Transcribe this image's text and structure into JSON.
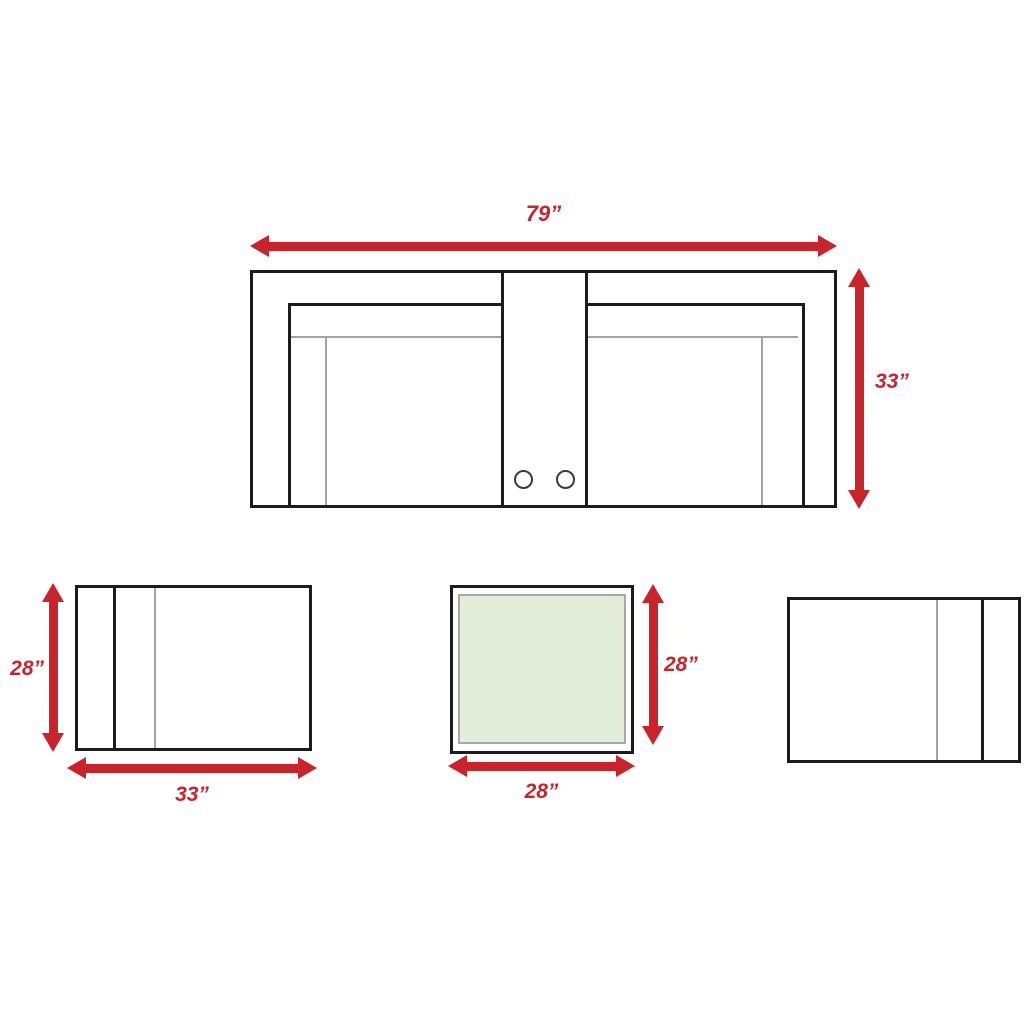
{
  "colors": {
    "arrow_red": "#c9232b",
    "label_red": "#c9232b",
    "outline_dark": "#1c1c1c",
    "thin_line_gray": "#a3a3a3",
    "ottoman_fill": "#e2eed9",
    "ottoman_inner_border": "#a8a8a8"
  },
  "loveseat_top_view": {
    "width_label": "79”",
    "depth_label": "33”",
    "cupholder_count": 2
  },
  "seat_side_view_left": {
    "height_label": "28”",
    "width_label": "33”"
  },
  "ottoman_top_view": {
    "height_label": "28”",
    "width_label": "28”"
  }
}
